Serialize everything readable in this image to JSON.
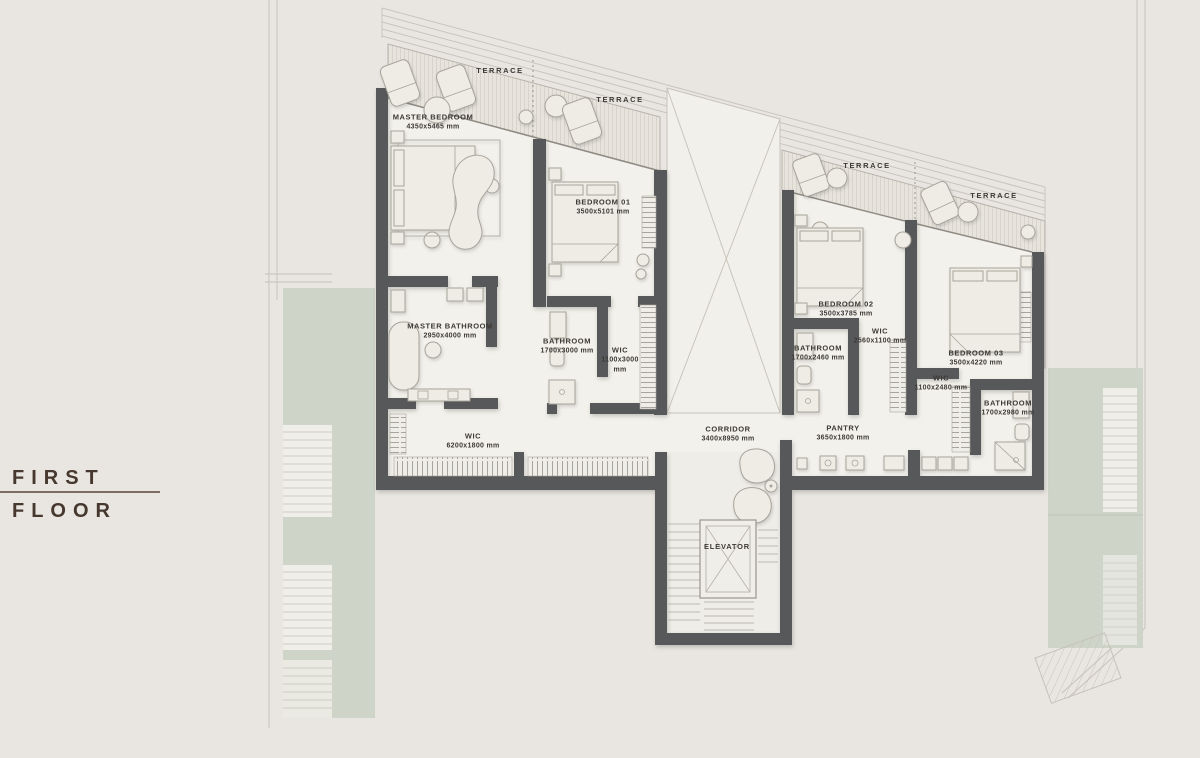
{
  "title": {
    "line1": "FIRST",
    "line2": "FLOOR"
  },
  "rooms": [
    {
      "name": "MASTER BEDROOM",
      "dims": "4350x5465 mm"
    },
    {
      "name": "BEDROOM 01",
      "dims": "3500x5101 mm"
    },
    {
      "name": "BEDROOM 02",
      "dims": "3500x3785 mm"
    },
    {
      "name": "BEDROOM 03",
      "dims": "3500x4220 mm"
    },
    {
      "name": "MASTER BATHROOM",
      "dims": "2950x4000 mm"
    },
    {
      "name": "BATHROOM",
      "dims": "1700x3000 mm"
    },
    {
      "name": "WIC",
      "dims": "1100x3000\nmm"
    },
    {
      "name": "BATHROOM",
      "dims": "1700x2460 mm"
    },
    {
      "name": "WIC",
      "dims": "2560x1100 mm"
    },
    {
      "name": "WIC",
      "dims": "1100x2480 mm"
    },
    {
      "name": "BATHROOM",
      "dims": "1700x2980 mm"
    },
    {
      "name": "WIC",
      "dims": "6200x1800 mm"
    },
    {
      "name": "CORRIDOR",
      "dims": "3400x8950 mm"
    },
    {
      "name": "PANTRY",
      "dims": "3650x1800 mm"
    }
  ],
  "terraces": [
    {
      "label": "TERRACE"
    },
    {
      "label": "TERRACE"
    },
    {
      "label": "TERRACE"
    },
    {
      "label": "TERRACE"
    }
  ],
  "elevator": {
    "label": "ELEVATOR"
  },
  "colors": {
    "background": "#e9e6e1",
    "wall": "#57585a",
    "greenery": "#cfd4c9",
    "label_text": "#3d3935",
    "title_text": "#46382e"
  }
}
